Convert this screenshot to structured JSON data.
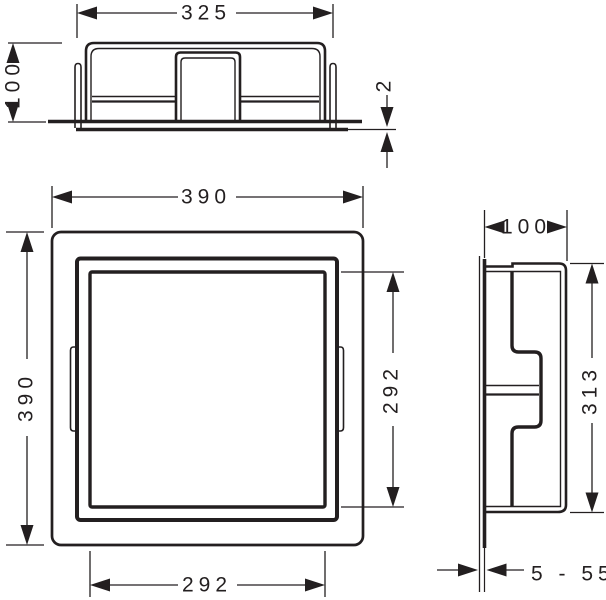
{
  "colors": {
    "background": "#ffffff",
    "line": "#231f20"
  },
  "dimensions": {
    "top_view": {
      "overall_width": "325",
      "depth": "100",
      "flange_thickness": "2"
    },
    "front_view": {
      "frame_width": "390",
      "frame_height": "390",
      "opening_height": "292",
      "opening_width": "292"
    },
    "side_view": {
      "depth": "100",
      "body_height": "313",
      "adjustment_range": "5 - 55"
    }
  }
}
